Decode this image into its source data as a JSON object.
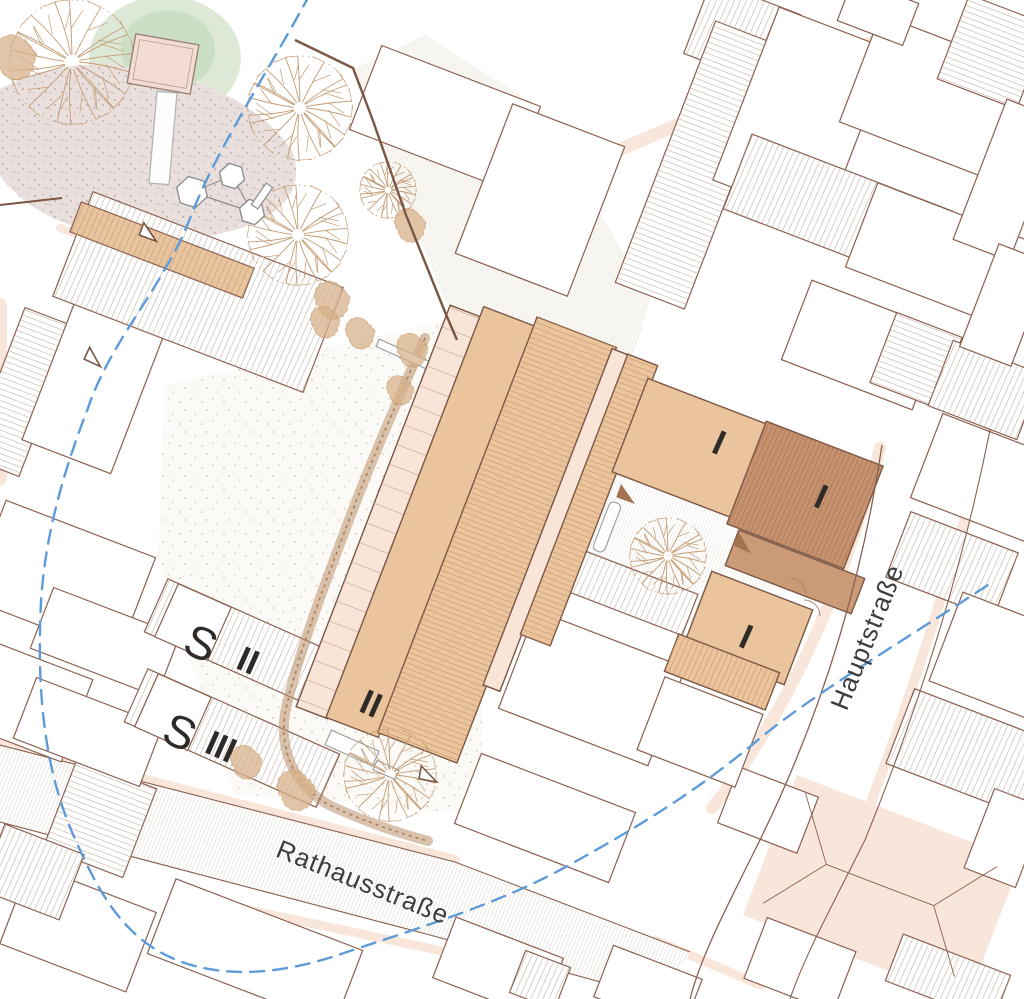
{
  "labels": {
    "street_rathausstrasse": "Rathausstraße",
    "street_hauptstrasse": "Hauptstraße",
    "bldg_s2_letter": "S",
    "bldg_s2_numeral": "II",
    "bldg_s3_letter": "S",
    "bldg_s3_numeral": "III",
    "bldg_central_numeral": "II",
    "bldg_east_a_numeral": "I",
    "bldg_east_b_numeral": "I",
    "bldg_east_c_numeral": "I"
  },
  "colors": {
    "background": "#ffffff",
    "outline": "#8a6050",
    "boundary": "#7a5644",
    "roof_hatch": "#a78d78",
    "peach_shadow": "#f8e6da",
    "tan_new_building": "#e9c49c",
    "tan_hatch_line": "#c08a5c",
    "dark_tan_building": "#c5916e",
    "dark_hatch_line": "#9d6a48",
    "pink_strip": "#f9e4d8",
    "rail_line": "#c2a18d",
    "street_hatch": "#c9bbab",
    "pave_hatch": "#d6ccc0",
    "stipple_fill": "#e9e0de",
    "stipple_dot": "#bfaeaa",
    "garden_dot": "#c5b49b",
    "green_light": "#dde9d6",
    "green_dark": "#cbdfc4",
    "tree_line": "#c49b72",
    "tree_fill": "#d9b28b",
    "hedge": "#b9906b",
    "stream_blue": "#5e9bd9",
    "platform_pink": "#f2dcd3",
    "equipment_gray": "#8f8f8f",
    "arrow_solid": "#a5724f",
    "label_color": "#2e2b28"
  }
}
